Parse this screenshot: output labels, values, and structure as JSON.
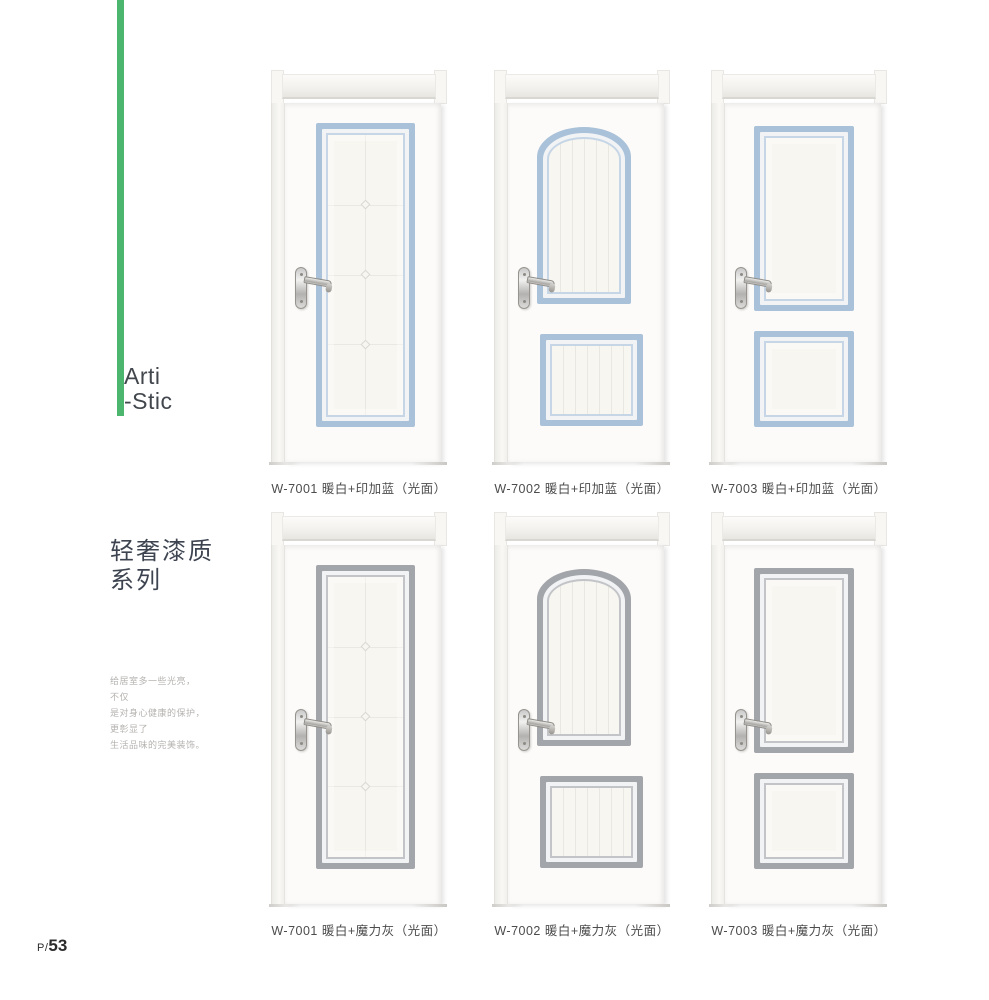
{
  "page": {
    "background": "#ffffff",
    "page_number_prefix": "P/",
    "page_number": "53"
  },
  "sidebar": {
    "accent_bar_color": "#4cb66e",
    "brand_line1": "Arti",
    "brand_line2": "-Stic",
    "series_title_line1": "轻奢漆质",
    "series_title_line2": "系列",
    "description_lines": [
      "给居室多一些光亮，",
      "不仅",
      "是对身心健康的保护，",
      "更彰显了",
      "生活品味的完美装饰。"
    ]
  },
  "colors": {
    "accent": "#4cb66e",
    "inca-blue": "#a9c1d9",
    "inca-blue-light": "#c6d6e6",
    "magic-gray": "#a2a5a9",
    "magic-gray-light": "#c2c4c7"
  },
  "doors": [
    {
      "model": "W-7001",
      "label": "W-7001 暖白+印加蓝（光面）"
    },
    {
      "model": "W-7002",
      "label": "W-7002 暖白+印加蓝（光面）"
    },
    {
      "model": "W-7003",
      "label": "W-7003 暖白+印加蓝（光面）"
    },
    {
      "model": "W-7001",
      "label": "W-7001 暖白+魔力灰（光面）"
    },
    {
      "model": "W-7002",
      "label": "W-7002 暖白+魔力灰（光面）"
    },
    {
      "model": "W-7003",
      "label": "W-7003 暖白+魔力灰（光面）"
    }
  ]
}
